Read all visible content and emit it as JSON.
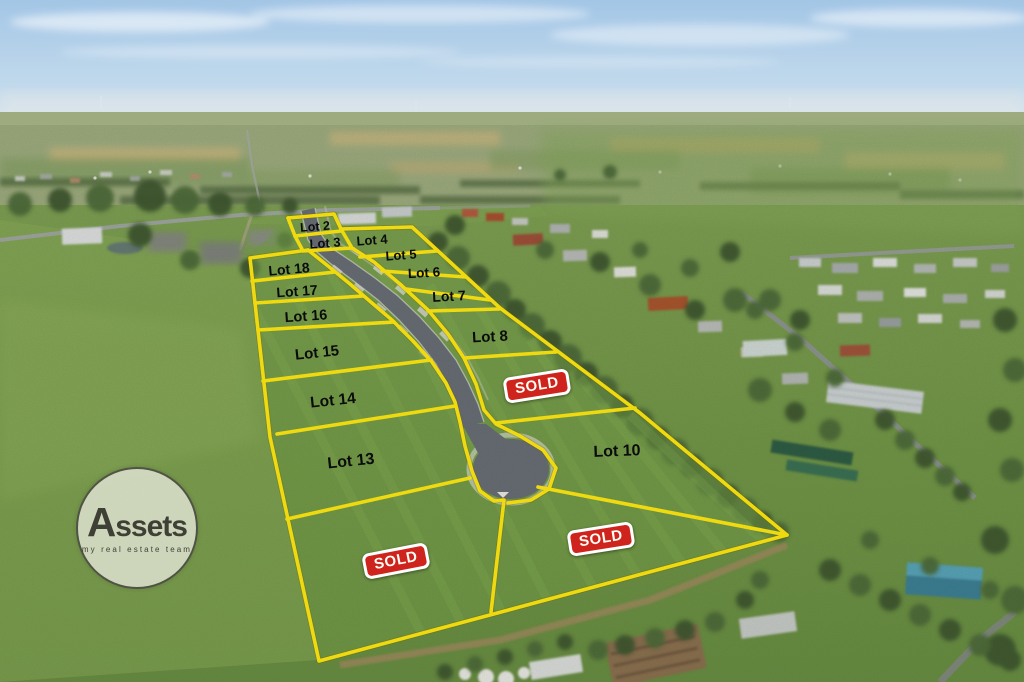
{
  "watermark": {
    "brand": "Assets",
    "tagline": "my real estate team"
  },
  "sold_label": "SOLD",
  "lots": [
    {
      "id": "2",
      "label": "Lot 2",
      "x": 315,
      "y": 227,
      "size": 12.5,
      "rot": -4
    },
    {
      "id": "3",
      "label": "Lot 3",
      "x": 325,
      "y": 243,
      "size": 13,
      "rot": -4
    },
    {
      "id": "4",
      "label": "Lot 4",
      "x": 372,
      "y": 240,
      "size": 13,
      "rot": -4
    },
    {
      "id": "5",
      "label": "Lot 5",
      "x": 401,
      "y": 255,
      "size": 13,
      "rot": -4
    },
    {
      "id": "6",
      "label": "Lot 6",
      "x": 424,
      "y": 273,
      "size": 13.5,
      "rot": -3
    },
    {
      "id": "7",
      "label": "Lot 7",
      "x": 449,
      "y": 296,
      "size": 14,
      "rot": -3
    },
    {
      "id": "8",
      "label": "Lot 8",
      "x": 490,
      "y": 337,
      "size": 15,
      "rot": -3
    },
    {
      "id": "10",
      "label": "Lot 10",
      "x": 617,
      "y": 452,
      "size": 16,
      "rot": -2
    },
    {
      "id": "13",
      "label": "Lot 13",
      "x": 351,
      "y": 462,
      "size": 16,
      "rot": -6
    },
    {
      "id": "14",
      "label": "Lot 14",
      "x": 333,
      "y": 401,
      "size": 15.5,
      "rot": -6
    },
    {
      "id": "15",
      "label": "Lot 15",
      "x": 317,
      "y": 353,
      "size": 15,
      "rot": -6
    },
    {
      "id": "16",
      "label": "Lot 16",
      "x": 306,
      "y": 317,
      "size": 14.5,
      "rot": -4
    },
    {
      "id": "17",
      "label": "Lot 17",
      "x": 297,
      "y": 291,
      "size": 14,
      "rot": -4
    },
    {
      "id": "18",
      "label": "Lot 18",
      "x": 289,
      "y": 269,
      "size": 14,
      "rot": -5
    }
  ],
  "sold_badges": [
    {
      "id": "sold-badge-upper",
      "x": 537,
      "y": 386,
      "rot": -9
    },
    {
      "id": "sold-badge-lower-left",
      "x": 396,
      "y": 561,
      "rot": -11
    },
    {
      "id": "sold-badge-lower-right",
      "x": 601,
      "y": 539,
      "rot": -9
    }
  ],
  "colors": {
    "boundary": "#ffe812",
    "sold_bg": "#cf231d",
    "sold_border": "#ffffff",
    "sold_text": "#fffdf4",
    "label": "#0b0b0b"
  }
}
